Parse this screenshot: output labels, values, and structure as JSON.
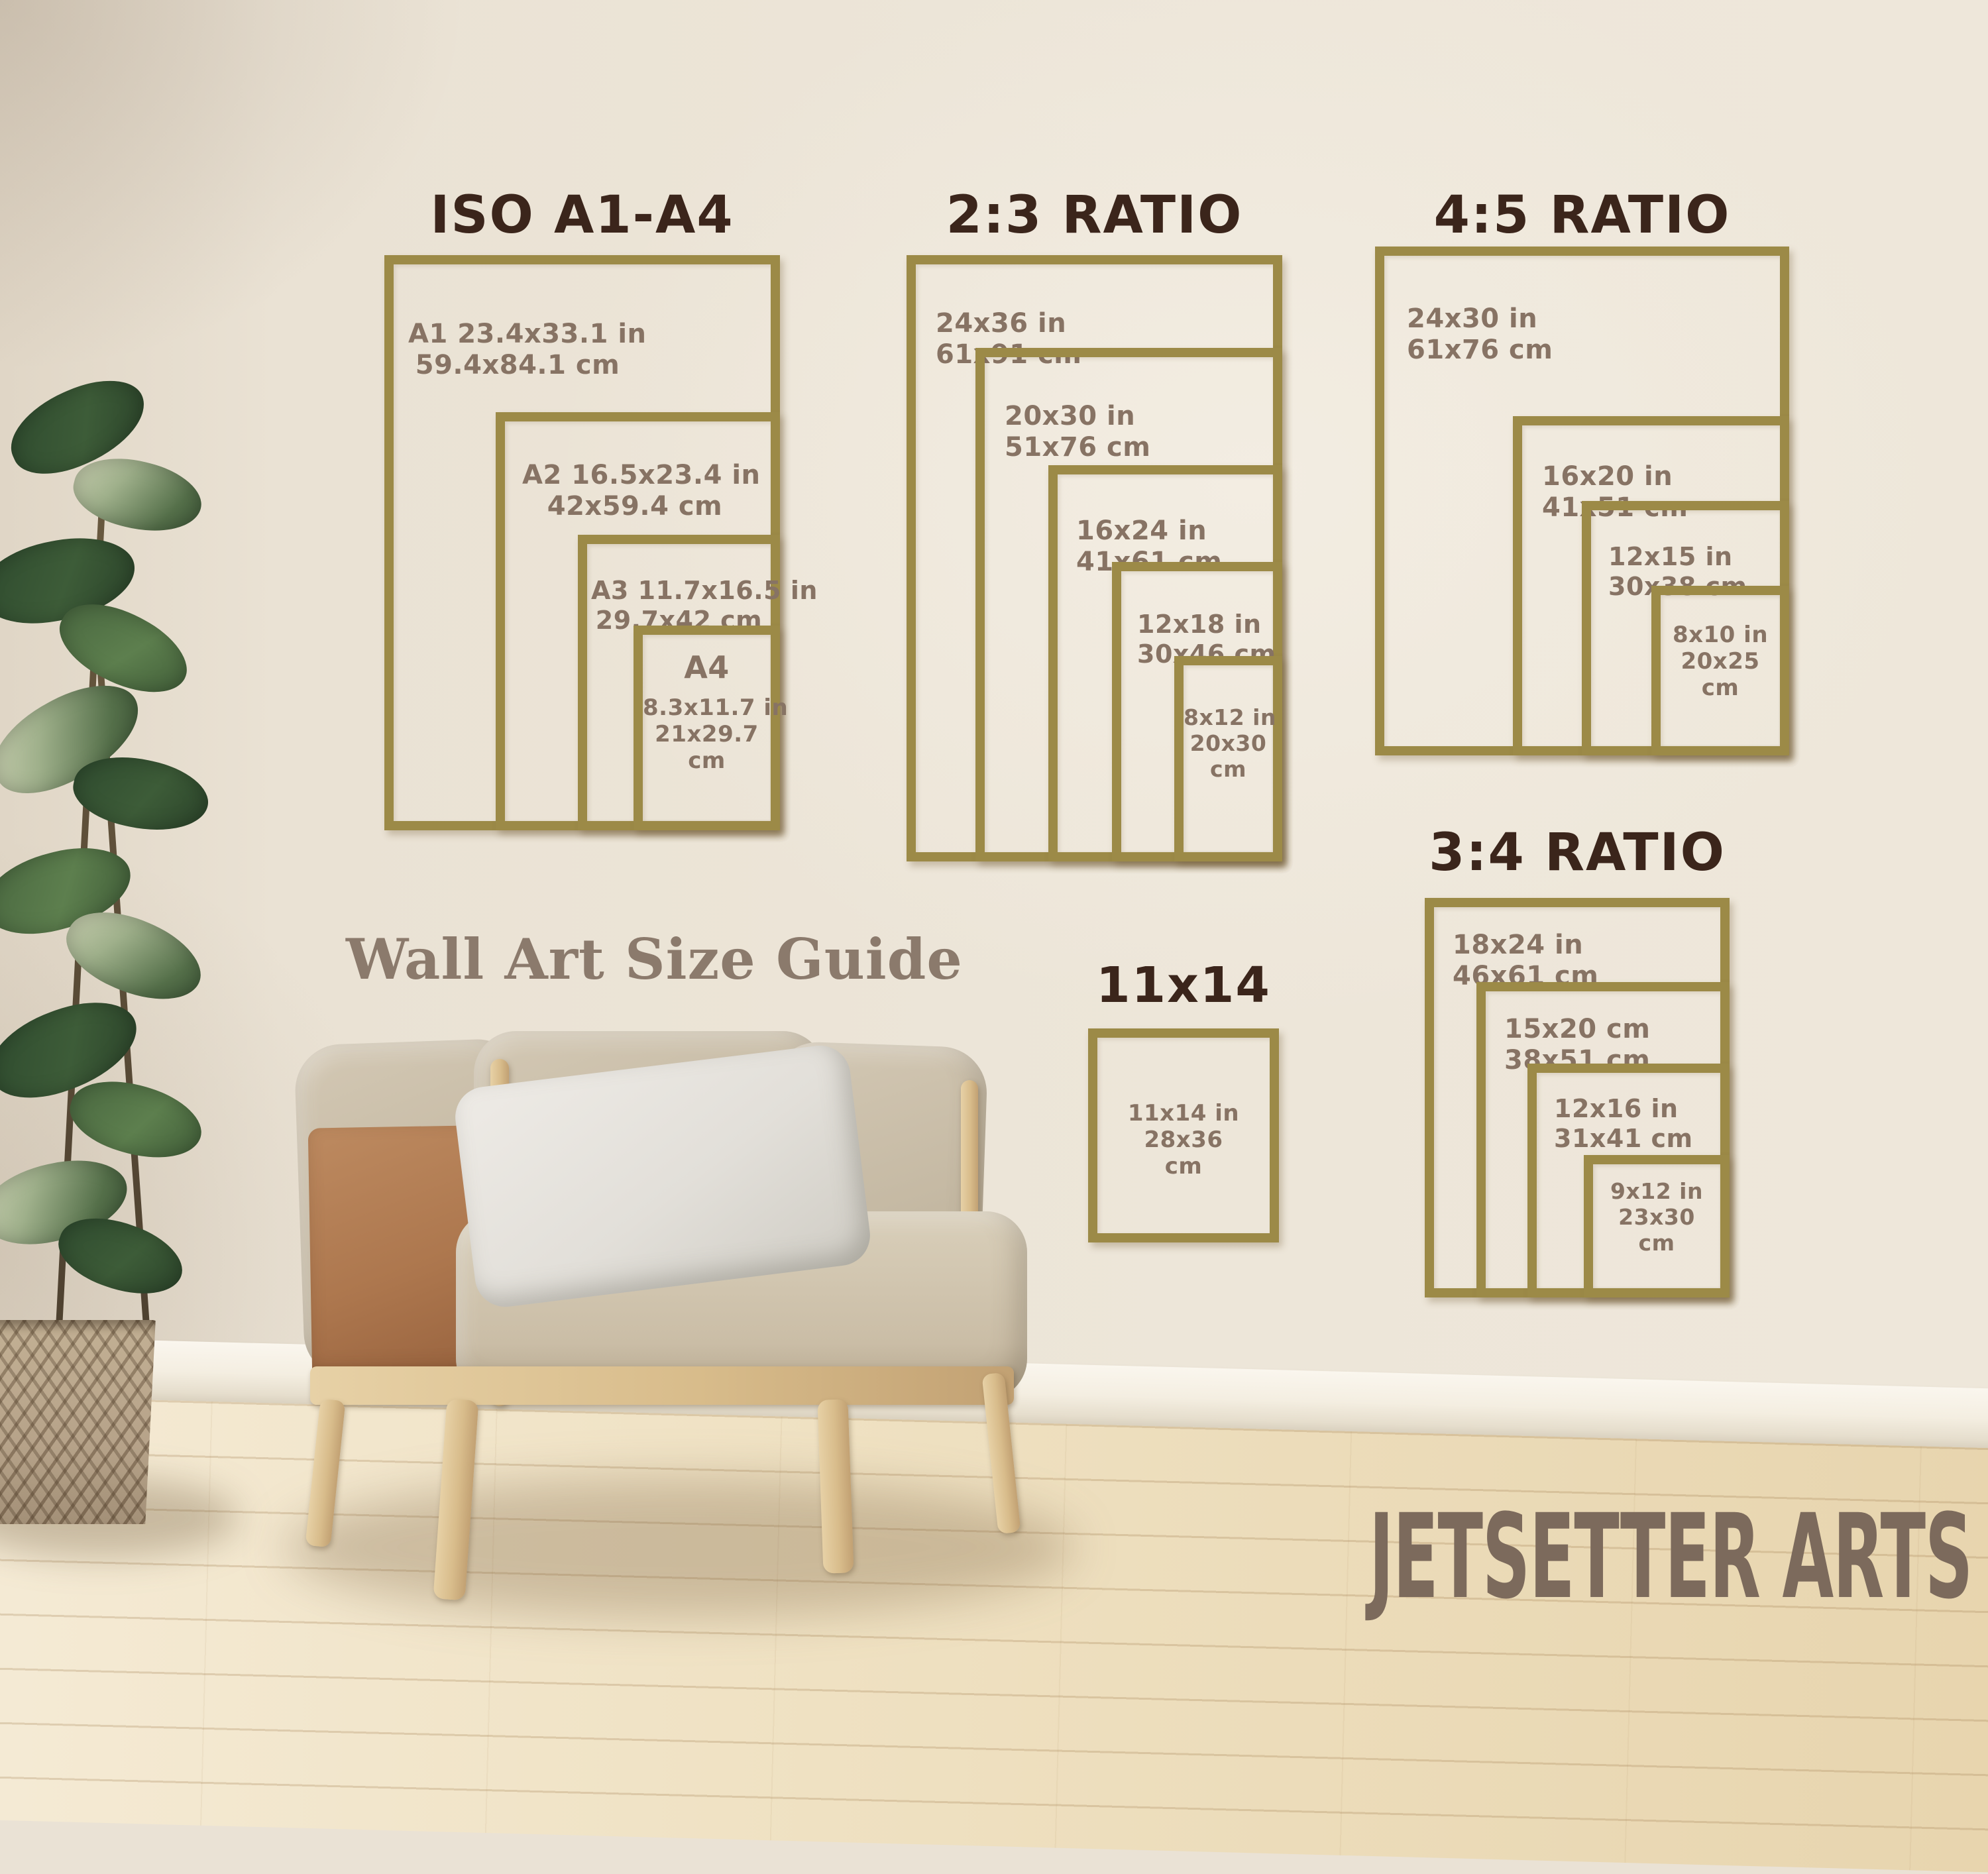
{
  "colors": {
    "frame_gold": "#9c8a47",
    "title_brown": "#3b251b",
    "label_brown": "#87ante",
    "label": "#877364",
    "caption": "#8b7a6c",
    "watermark": "#7c6a5c"
  },
  "guide": {
    "caption": "Wall Art Size Guide",
    "watermark": "JETSETTER ARTS",
    "groups": {
      "iso": {
        "title": "ISO A1-A4",
        "frames": {
          "a1": {
            "l1": "A1 23.4x33.1 in",
            "l2": "59.4x84.1 cm"
          },
          "a2": {
            "l1": "A2 16.5x23.4 in",
            "l2": "42x59.4 cm"
          },
          "a3": {
            "l1": "A3 11.7x16.5 in",
            "l2": "29.7x42 cm"
          },
          "a4": {
            "l1": "A4",
            "l2": "8.3x11.7 in",
            "l3": "21x29.7",
            "l4": "cm"
          }
        }
      },
      "r23": {
        "title": "2:3 RATIO",
        "frames": {
          "f24x36": {
            "l1": "24x36 in",
            "l2": "61x91 cm"
          },
          "f20x30": {
            "l1": "20x30 in",
            "l2": "51x76 cm"
          },
          "f16x24": {
            "l1": "16x24 in",
            "l2": "41x61 cm"
          },
          "f12x18": {
            "l1": "12x18 in",
            "l2": "30x46 cm"
          },
          "f8x12": {
            "l1": "8x12 in",
            "l2": "20x30",
            "l3": "cm"
          }
        }
      },
      "r45": {
        "title": "4:5 RATIO",
        "frames": {
          "f24x30": {
            "l1": "24x30 in",
            "l2": "61x76 cm"
          },
          "f16x20": {
            "l1": "16x20 in",
            "l2": "41x51 cm"
          },
          "f12x15": {
            "l1": "12x15 in",
            "l2": "30x38 cm"
          },
          "f8x10": {
            "l1": "8x10 in",
            "l2": "20x25",
            "l3": "cm"
          }
        }
      },
      "r34": {
        "title": "3:4 RATIO",
        "frames": {
          "f18x24": {
            "l1": "18x24 in",
            "l2": "46x61 cm"
          },
          "f15x20": {
            "l1": "15x20 cm",
            "l2": "38x51 cm"
          },
          "f12x16": {
            "l1": "12x16 in",
            "l2": "31x41 cm"
          },
          "f9x12": {
            "l1": "9x12 in",
            "l2": "23x30",
            "l3": "cm"
          }
        }
      },
      "s1114": {
        "title": "11x14",
        "frames": {
          "f11x14": {
            "l1": "11x14 in",
            "l2": "28x36",
            "l3": "cm"
          }
        }
      }
    }
  }
}
